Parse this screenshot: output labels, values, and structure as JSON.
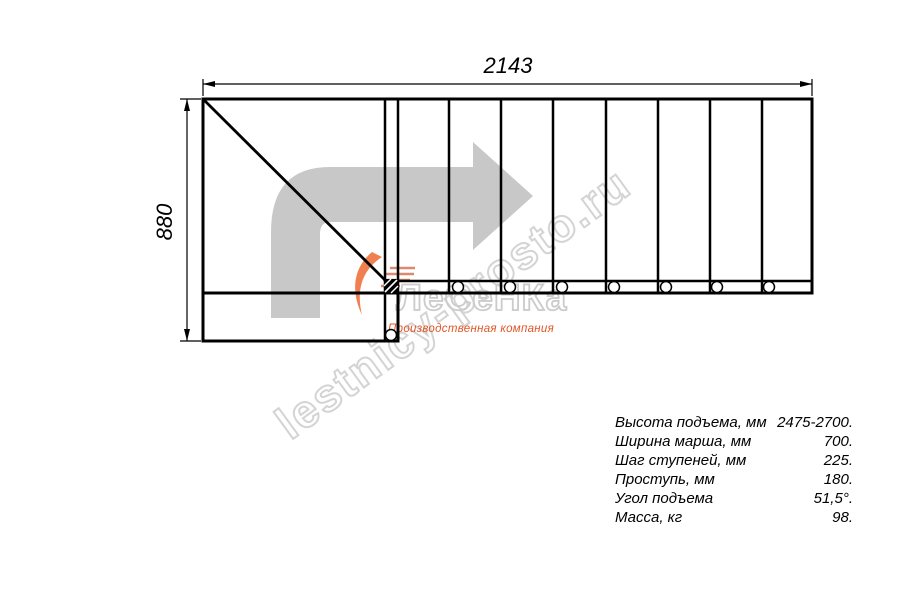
{
  "drawing": {
    "title": "staircase-top-view-plan",
    "width_dimension_label": "2143",
    "height_dimension_label": "880",
    "step_count_shown": 8,
    "mount_hole_count": 8
  },
  "watermark": {
    "diagonal_text": "lestnicy-prosto.ru",
    "logo_text": "ЛеСеНКа",
    "tagline": "Производственная компания"
  },
  "icons": {
    "direction_arrow": "turn-right-direction-arrow",
    "logo_flame": "orange-flame-swoosh"
  },
  "specs": {
    "rows": [
      {
        "label": "Высота подъема, мм",
        "value": "2475-2700."
      },
      {
        "label": "Ширина марша, мм",
        "value": "700."
      },
      {
        "label": "Шаг ступеней, мм",
        "value": "225."
      },
      {
        "label": "Проступь, мм",
        "value": "180."
      },
      {
        "label": "Угол подъема",
        "value": "51,5°."
      },
      {
        "label": "Масса, кг",
        "value": "98."
      }
    ]
  },
  "colors": {
    "line": "#000000",
    "arrow_gray": "#c8c8c8",
    "watermark_outline": "#d4d4d4",
    "accent_orange": "#e25526"
  }
}
